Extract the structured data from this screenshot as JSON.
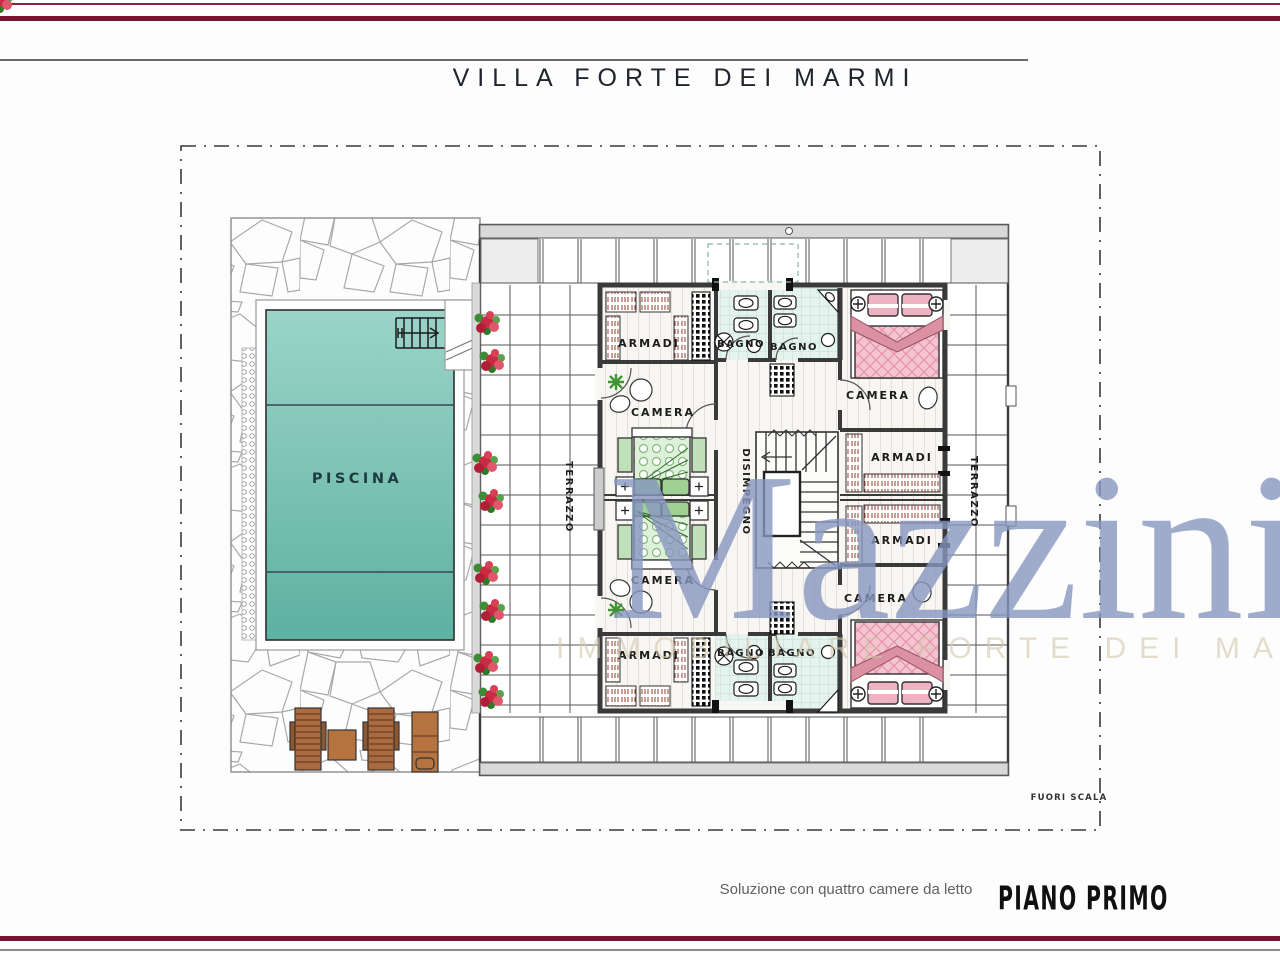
{
  "header": {
    "title": "VILLA FORTE DEI MARMI"
  },
  "footer": {
    "caption": "Soluzione con quattro camere da letto",
    "floor_label": "PIANO PRIMO"
  },
  "watermark": {
    "name": "Mazzini",
    "subtitle": "IMMOBILIARE FORTE DEI MARMI",
    "name_color": "#8897bf",
    "subtitle_color": "#d6c9ae"
  },
  "plan": {
    "scale_note": "FUORI SCALA",
    "labels": {
      "piscina": "PISCINA",
      "terrazzo_left": "TERRAZZO",
      "terrazzo_right": "TERRAZZO",
      "disimpegno": "DISIMPEGNO",
      "camera_tl": "CAMERA",
      "camera_tr": "CAMERA",
      "camera_bl": "CAMERA",
      "camera_br": "CAMERA",
      "armadi_tl": "ARMADI",
      "armadi_bl": "ARMADI",
      "armadi_r1": "ARMADI",
      "armadi_r2": "ARMADI",
      "bagno_t1": "BAGNO",
      "bagno_t2": "BAGNO",
      "bagno_b1": "BAGNO",
      "bagno_b2": "BAGNO"
    }
  },
  "colors": {
    "accent_maroon": "#771430",
    "pool_teal": "#7cc4b6",
    "bed_pink": "#f3c0cd",
    "bed_green": "#cdeac6",
    "tile_mint": "#e4f3ee"
  }
}
